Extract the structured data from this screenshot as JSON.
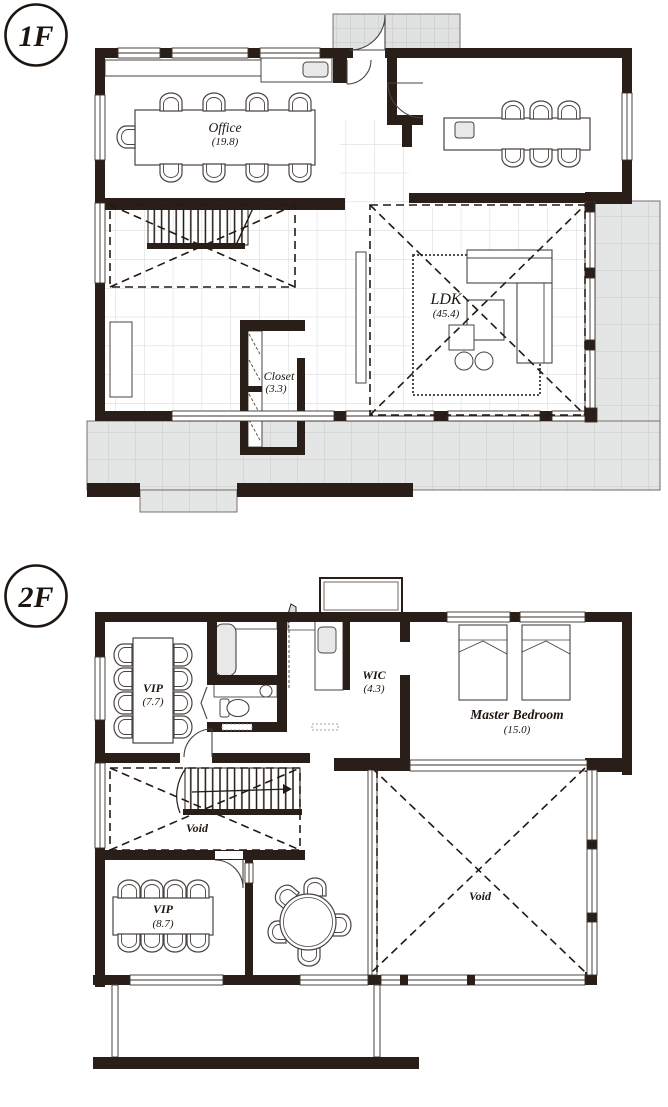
{
  "floors": [
    {
      "label": "1F",
      "rooms": {
        "office": {
          "name": "Office",
          "area": "(19.8)"
        },
        "ldk": {
          "name": "LDK",
          "area": "(45.4)"
        },
        "closet": {
          "name": "Closet",
          "area": "(3.3)"
        }
      }
    },
    {
      "label": "2F",
      "rooms": {
        "vip_north": {
          "name": "VIP",
          "area": "(7.7)"
        },
        "wic": {
          "name": "WIC",
          "area": "(4.3)"
        },
        "master_bedroom": {
          "name": "Master Bedroom",
          "area": "(15.0)"
        },
        "void_stair": {
          "name": "Void"
        },
        "vip_south": {
          "name": "VIP",
          "area": "(8.7)"
        },
        "void_main": {
          "name": "Void"
        }
      }
    }
  ],
  "colors": {
    "wall": "#2a1e18",
    "line": "#4a4340",
    "deck_fill": "#e4e6e5",
    "deck_grid": "#c9cbca",
    "tile_grid": "#d5d6d5",
    "fixture_fill": "#e7e8e7"
  }
}
